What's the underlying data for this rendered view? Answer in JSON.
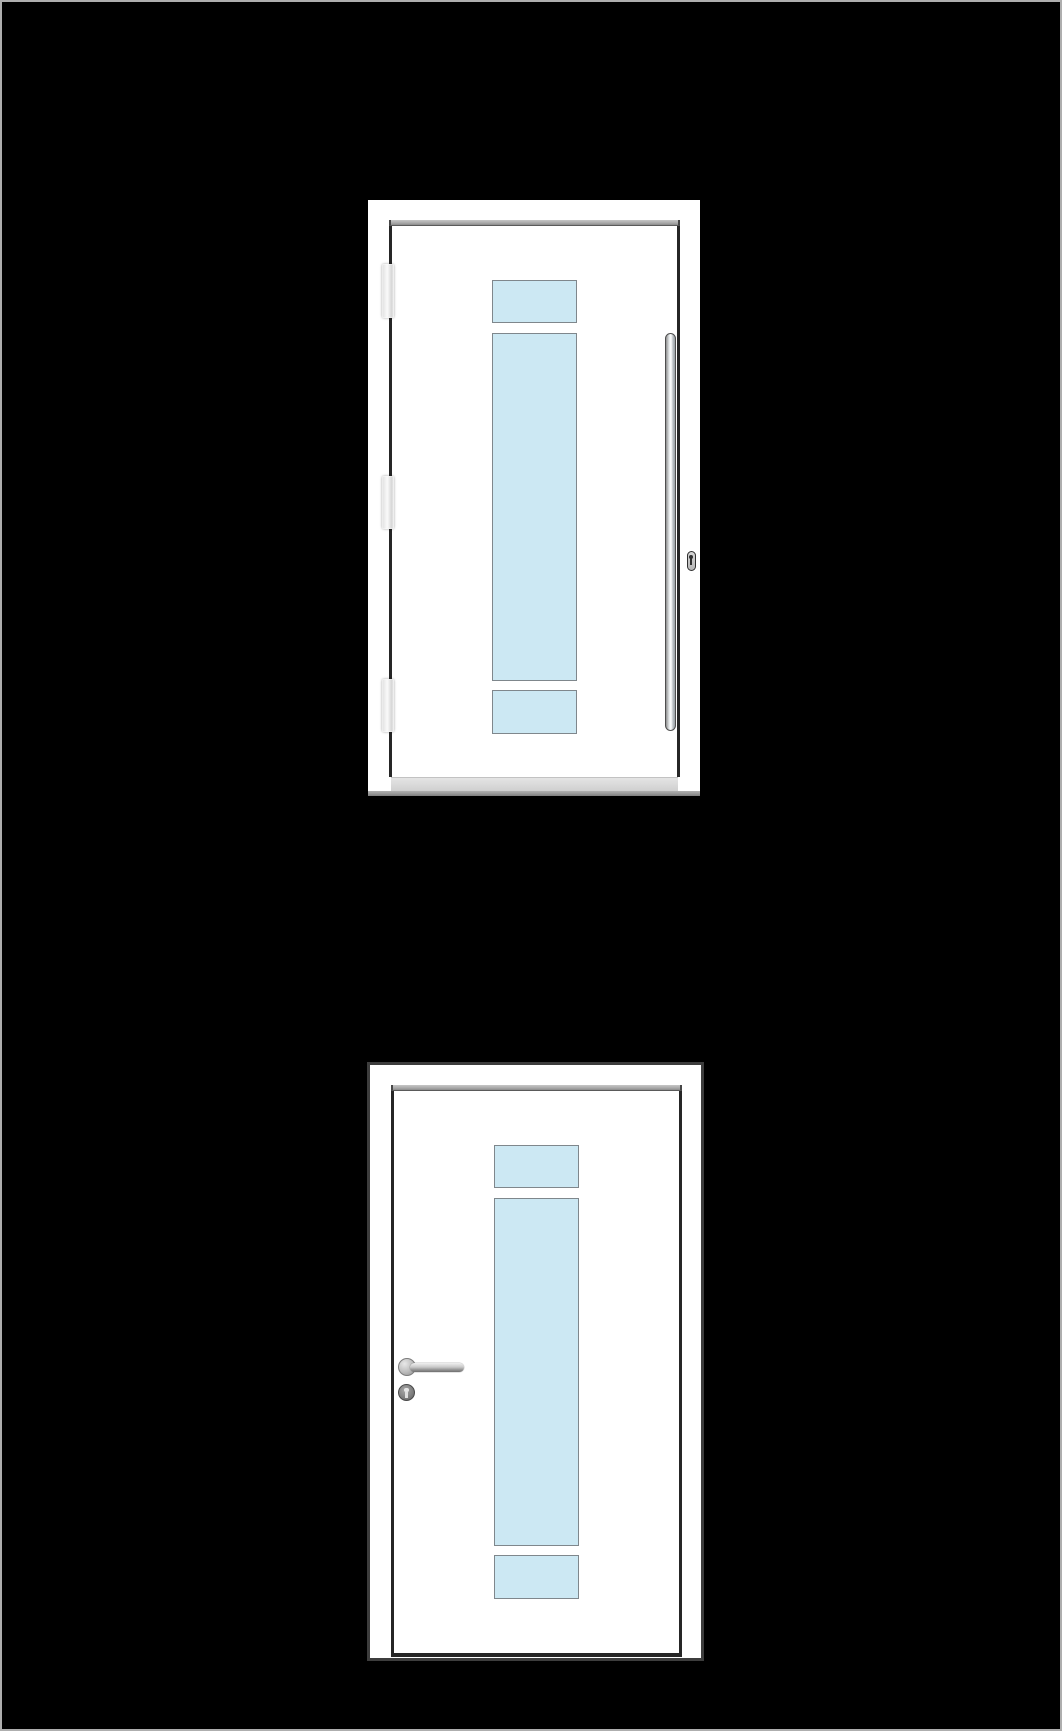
{
  "scene": {
    "description": "Two white door product illustrations stacked vertically on a black background",
    "background": "#000000",
    "outer_border_color": "#aeaeae"
  },
  "colors": {
    "door_white": "#ffffff",
    "slab_outline": "#262626",
    "frame_border_dark": "#3d3d3d",
    "glass": "#cce8f3",
    "glass_border": "#7f878c",
    "metal_light": "#e9edef",
    "metal_mid": "#b9bfc3",
    "metal_dark": "#6f6f6f",
    "sill_gray": "#d9d9d9",
    "threshold_gray": "#9a9a9a"
  },
  "doors": [
    {
      "name": "entry-door-pull-handle",
      "position": "top",
      "hinge_side": "left",
      "hinge_count": 3,
      "handle": "vertical-pull-bar",
      "handle_side": "right",
      "lock": "euro-cylinder",
      "glass_panes": [
        "small-top",
        "tall-middle",
        "small-bottom"
      ],
      "has_threshold": true
    },
    {
      "name": "interior-door-lever-handle",
      "position": "bottom",
      "hinge_side": "none-visible",
      "hinge_count": 0,
      "handle": "lever-handle",
      "handle_side": "left",
      "lock": "keyhole-rosette",
      "glass_panes": [
        "small-top",
        "tall-middle",
        "small-bottom"
      ],
      "has_threshold": false
    }
  ]
}
